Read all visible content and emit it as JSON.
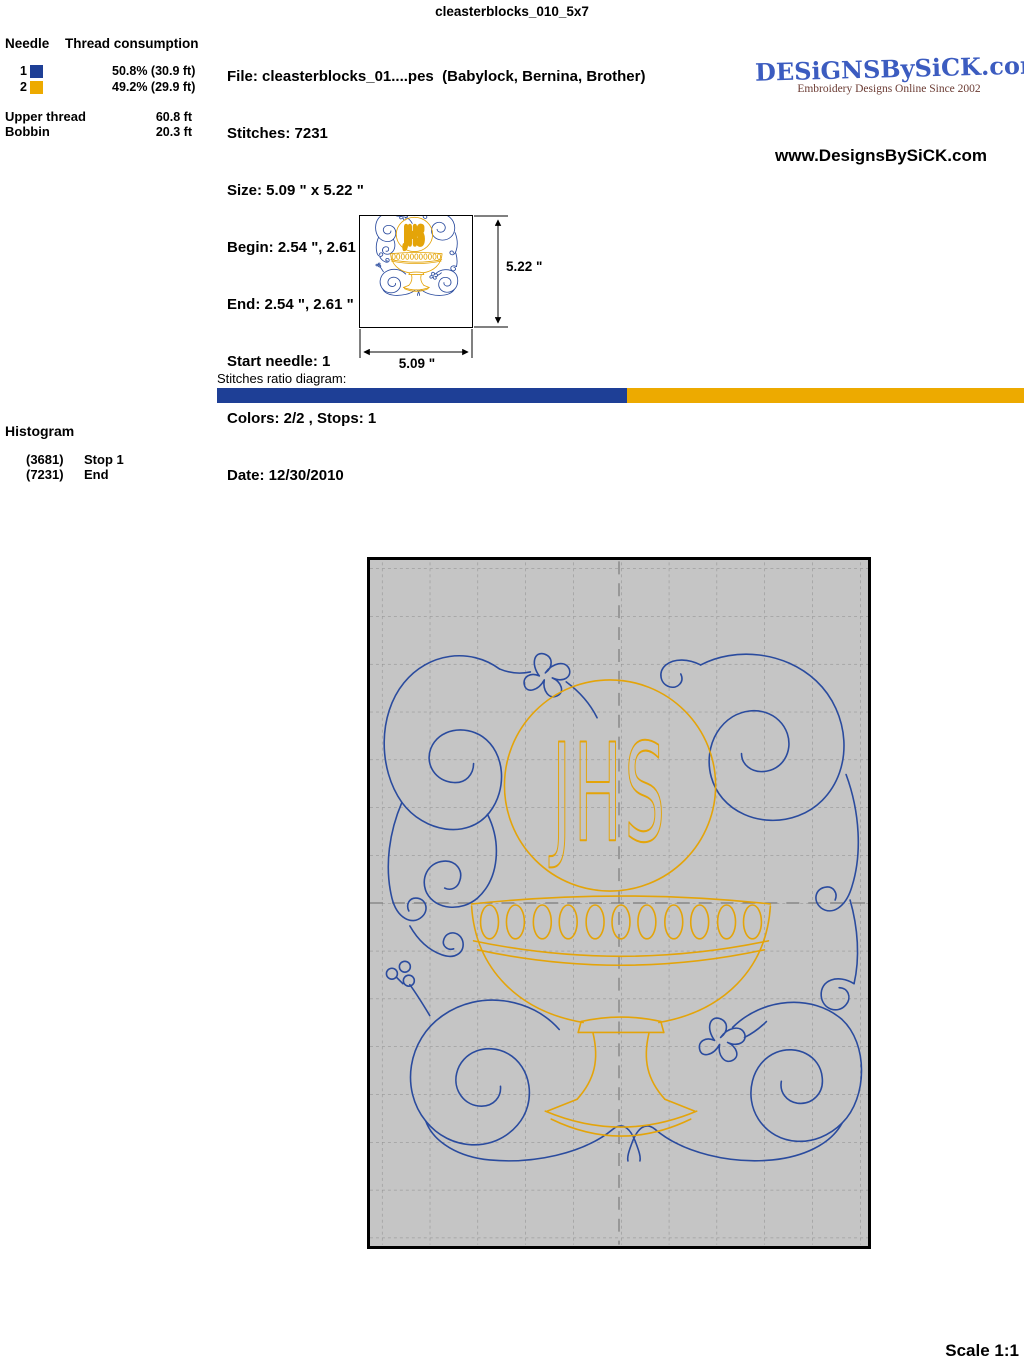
{
  "page": {
    "title": "cleasterblocks_010_5x7",
    "scale_label": "Scale 1:1"
  },
  "thread_table": {
    "col_needle": "Needle",
    "col_consumption": "Thread consumption",
    "rows": [
      {
        "needle": "1",
        "color": "#1e3f96",
        "consumption": "50.8% (30.9 ft)"
      },
      {
        "needle": "2",
        "color": "#edaa00",
        "consumption": "49.2% (29.9 ft)"
      }
    ],
    "upper_thread_label": "Upper thread",
    "upper_thread_value": "60.8 ft",
    "bobbin_label": "Bobbin",
    "bobbin_value": "20.3 ft"
  },
  "file_info": {
    "lines": [
      "File: cleasterblocks_01....pes  (Babylock, Bernina, Brother)",
      "Stitches: 7231",
      "Size: 5.09 \" x 5.22 \"",
      "Begin: 2.54 \", 2.61 \"",
      "End: 2.54 \", 2.61 \"",
      "Start needle: 1",
      "Colors: 2/2 , Stops: 1",
      "Date: 12/30/2010"
    ]
  },
  "branding": {
    "logo_text": "DESiGNSBySiCK.com",
    "logo_color": "#3c5cc0",
    "tagline": "Embroidery Designs Online Since 2002",
    "tagline_color": "#6b3b33",
    "website": "www.DesignsBySiCK.com"
  },
  "preview": {
    "height_label": "5.22 \"",
    "width_label": "5.09 \""
  },
  "ratio_diagram": {
    "label": "Stitches ratio diagram:",
    "segments": [
      {
        "name": "needle-1",
        "color": "#1e3f96",
        "percent": 50.8
      },
      {
        "name": "needle-2",
        "color": "#edaa00",
        "percent": 49.2
      }
    ]
  },
  "histogram": {
    "title": "Histogram",
    "entries": [
      {
        "count": "(3681)",
        "label": "Stop 1"
      },
      {
        "count": "(7231)",
        "label": "End"
      }
    ]
  },
  "design": {
    "monogram": "JHS",
    "blue": "#2a4b9e",
    "gold": "#e4a409"
  }
}
